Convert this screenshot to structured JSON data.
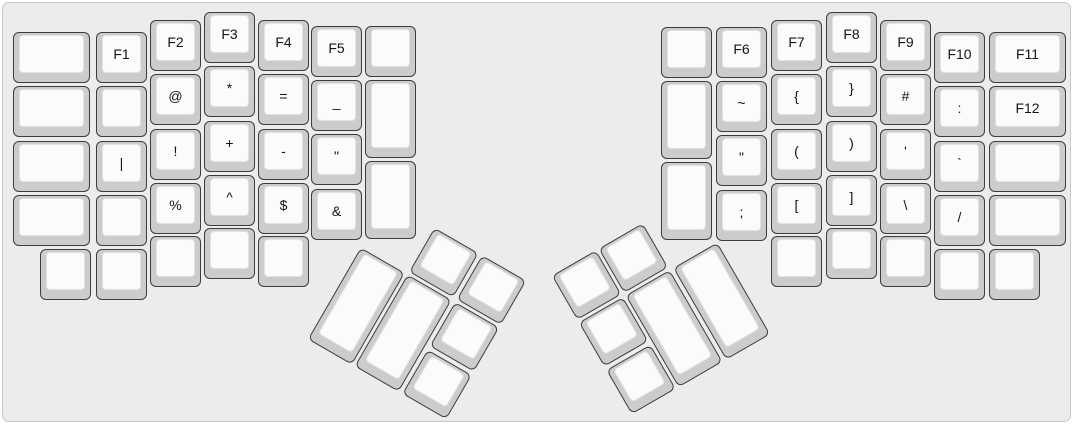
{
  "canvas": {
    "width": 1073,
    "height": 424,
    "background": "#ececec",
    "border_color": "#c8c8c8",
    "keycap_side_color": "#cccccc",
    "keycap_top_color": "#fbfbfb",
    "keycap_outline_color": "#3d3d3d",
    "label_color": "#141414"
  },
  "halves": {
    "left_main": {
      "keys": [
        {
          "label": "",
          "x": 10,
          "y": 29,
          "w": 77,
          "h": 51
        },
        {
          "label": "",
          "x": 10,
          "y": 83,
          "w": 77,
          "h": 51
        },
        {
          "label": "",
          "x": 10,
          "y": 138,
          "w": 77,
          "h": 51
        },
        {
          "label": "",
          "x": 10,
          "y": 192,
          "w": 77,
          "h": 51
        },
        {
          "label": "F1",
          "x": 93,
          "y": 29,
          "w": 51,
          "h": 51
        },
        {
          "label": "",
          "x": 93,
          "y": 83,
          "w": 51,
          "h": 51
        },
        {
          "label": "|",
          "x": 93,
          "y": 138,
          "w": 51,
          "h": 51
        },
        {
          "label": "",
          "x": 93,
          "y": 192,
          "w": 51,
          "h": 51
        },
        {
          "label": "F2",
          "x": 147,
          "y": 17,
          "w": 51,
          "h": 51
        },
        {
          "label": "@",
          "x": 147,
          "y": 71,
          "w": 51,
          "h": 51
        },
        {
          "label": "!",
          "x": 147,
          "y": 126,
          "w": 51,
          "h": 51
        },
        {
          "label": "%",
          "x": 147,
          "y": 180,
          "w": 51,
          "h": 51
        },
        {
          "label": "F3",
          "x": 201,
          "y": 9,
          "w": 51,
          "h": 51
        },
        {
          "label": "*",
          "x": 201,
          "y": 63,
          "w": 51,
          "h": 51
        },
        {
          "label": "+",
          "x": 201,
          "y": 118,
          "w": 51,
          "h": 51
        },
        {
          "label": "^",
          "x": 201,
          "y": 172,
          "w": 51,
          "h": 51
        },
        {
          "label": "F4",
          "x": 255,
          "y": 17,
          "w": 51,
          "h": 51
        },
        {
          "label": "=",
          "x": 255,
          "y": 71,
          "w": 51,
          "h": 51
        },
        {
          "label": "-",
          "x": 255,
          "y": 126,
          "w": 51,
          "h": 51
        },
        {
          "label": "$",
          "x": 255,
          "y": 180,
          "w": 51,
          "h": 51
        },
        {
          "label": "F5",
          "x": 308,
          "y": 23,
          "w": 51,
          "h": 51
        },
        {
          "label": "_",
          "x": 308,
          "y": 77,
          "w": 51,
          "h": 51
        },
        {
          "label": "\"",
          "x": 308,
          "y": 131,
          "w": 51,
          "h": 51
        },
        {
          "label": "&",
          "x": 308,
          "y": 186,
          "w": 51,
          "h": 51
        },
        {
          "label": "",
          "x": 362,
          "y": 23,
          "w": 51,
          "h": 51
        },
        {
          "label": "",
          "x": 362,
          "y": 77,
          "w": 51,
          "h": 78
        },
        {
          "label": "",
          "x": 362,
          "y": 158,
          "w": 51,
          "h": 78
        },
        {
          "label": "",
          "x": 37,
          "y": 246,
          "w": 51,
          "h": 51
        },
        {
          "label": "",
          "x": 93,
          "y": 246,
          "w": 51,
          "h": 51
        },
        {
          "label": "",
          "x": 147,
          "y": 233,
          "w": 51,
          "h": 51
        },
        {
          "label": "",
          "x": 201,
          "y": 225,
          "w": 51,
          "h": 51
        },
        {
          "label": "",
          "x": 255,
          "y": 233,
          "w": 51,
          "h": 51
        }
      ]
    },
    "right_main": {
      "keys": [
        {
          "label": "",
          "x": 658,
          "y": 24,
          "w": 51,
          "h": 51
        },
        {
          "label": "",
          "x": 658,
          "y": 78,
          "w": 51,
          "h": 78
        },
        {
          "label": "",
          "x": 658,
          "y": 159,
          "w": 51,
          "h": 78
        },
        {
          "label": "F6",
          "x": 713,
          "y": 24,
          "w": 51,
          "h": 51
        },
        {
          "label": "~",
          "x": 713,
          "y": 78,
          "w": 51,
          "h": 51
        },
        {
          "label": "\"",
          "x": 713,
          "y": 132,
          "w": 51,
          "h": 51
        },
        {
          "label": ";",
          "x": 713,
          "y": 187,
          "w": 51,
          "h": 51
        },
        {
          "label": "F7",
          "x": 768,
          "y": 17,
          "w": 51,
          "h": 51
        },
        {
          "label": "{",
          "x": 768,
          "y": 71,
          "w": 51,
          "h": 51
        },
        {
          "label": "(",
          "x": 768,
          "y": 126,
          "w": 51,
          "h": 51
        },
        {
          "label": "[",
          "x": 768,
          "y": 180,
          "w": 51,
          "h": 51
        },
        {
          "label": "F8",
          "x": 823,
          "y": 9,
          "w": 51,
          "h": 51
        },
        {
          "label": "}",
          "x": 823,
          "y": 63,
          "w": 51,
          "h": 51
        },
        {
          "label": ")",
          "x": 823,
          "y": 118,
          "w": 51,
          "h": 51
        },
        {
          "label": "]",
          "x": 823,
          "y": 172,
          "w": 51,
          "h": 51
        },
        {
          "label": "F9",
          "x": 877,
          "y": 17,
          "w": 51,
          "h": 51
        },
        {
          "label": "#",
          "x": 877,
          "y": 71,
          "w": 51,
          "h": 51
        },
        {
          "label": "'",
          "x": 877,
          "y": 126,
          "w": 51,
          "h": 51
        },
        {
          "label": "\\",
          "x": 877,
          "y": 180,
          "w": 51,
          "h": 51
        },
        {
          "label": "F10",
          "x": 931,
          "y": 29,
          "w": 51,
          "h": 51
        },
        {
          "label": ":",
          "x": 931,
          "y": 83,
          "w": 51,
          "h": 51
        },
        {
          "label": "`",
          "x": 931,
          "y": 138,
          "w": 51,
          "h": 51
        },
        {
          "label": "/",
          "x": 931,
          "y": 192,
          "w": 51,
          "h": 51
        },
        {
          "label": "F11",
          "x": 986,
          "y": 29,
          "w": 77,
          "h": 51
        },
        {
          "label": "F12",
          "x": 986,
          "y": 83,
          "w": 77,
          "h": 51
        },
        {
          "label": "",
          "x": 986,
          "y": 138,
          "w": 77,
          "h": 51
        },
        {
          "label": "",
          "x": 986,
          "y": 192,
          "w": 77,
          "h": 51
        },
        {
          "label": "",
          "x": 768,
          "y": 233,
          "w": 51,
          "h": 51
        },
        {
          "label": "",
          "x": 823,
          "y": 225,
          "w": 51,
          "h": 51
        },
        {
          "label": "",
          "x": 877,
          "y": 233,
          "w": 51,
          "h": 51
        },
        {
          "label": "",
          "x": 931,
          "y": 246,
          "w": 51,
          "h": 51
        },
        {
          "label": "",
          "x": 986,
          "y": 246,
          "w": 51,
          "h": 51
        }
      ]
    },
    "left_thumb": {
      "origin_x": 384,
      "origin_y": 195,
      "rotation_deg": 30,
      "keys": [
        {
          "label": "",
          "x": 56,
          "y": 2,
          "w": 51,
          "h": 51
        },
        {
          "label": "",
          "x": 111,
          "y": 2,
          "w": 51,
          "h": 51
        },
        {
          "label": "",
          "x": 2,
          "y": 56,
          "w": 51,
          "h": 106
        },
        {
          "label": "",
          "x": 56,
          "y": 56,
          "w": 51,
          "h": 106
        },
        {
          "label": "",
          "x": 111,
          "y": 56,
          "w": 51,
          "h": 51
        },
        {
          "label": "",
          "x": 111,
          "y": 111,
          "w": 51,
          "h": 51
        }
      ]
    },
    "right_thumb": {
      "origin_x": 546,
      "origin_y": 272,
      "rotation_deg": -30,
      "keys": [
        {
          "label": "",
          "x": 2,
          "y": 2,
          "w": 51,
          "h": 51
        },
        {
          "label": "",
          "x": 56,
          "y": 2,
          "w": 51,
          "h": 51
        },
        {
          "label": "",
          "x": 2,
          "y": 56,
          "w": 51,
          "h": 51
        },
        {
          "label": "",
          "x": 56,
          "y": 56,
          "w": 51,
          "h": 106
        },
        {
          "label": "",
          "x": 111,
          "y": 56,
          "w": 51,
          "h": 106
        },
        {
          "label": "",
          "x": 2,
          "y": 111,
          "w": 51,
          "h": 51
        }
      ]
    }
  }
}
